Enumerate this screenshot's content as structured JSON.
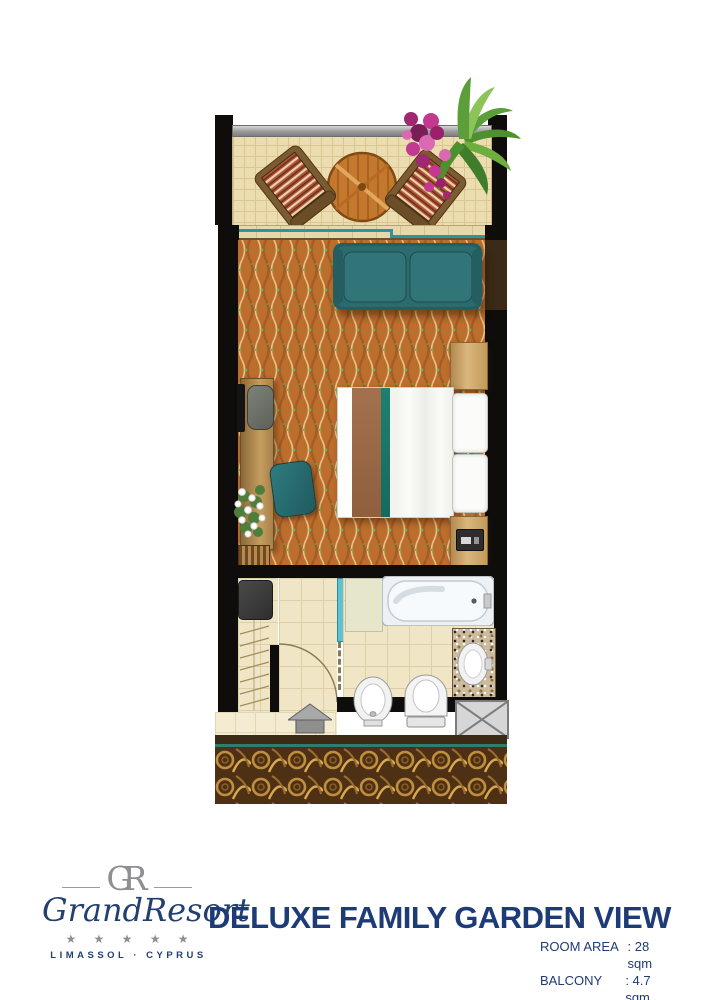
{
  "branding": {
    "monogram": "GR",
    "name": "GrandResort",
    "stars": "★ ★ ★ ★ ★",
    "location": "LIMASSOL · CYPRUS"
  },
  "room": {
    "title": "DELUXE FAMILY GARDEN VIEW",
    "specs": [
      {
        "label": "ROOM AREA",
        "value": ": 28 sqm"
      },
      {
        "label": "BALCONY",
        "value": ": 4.7 sqm"
      }
    ]
  },
  "colors": {
    "brand_navy": "#1d3b76",
    "logo_gray": "#8f8f91",
    "carpet_orange": "#bc6e2d",
    "accent_teal": "#2b6b6e",
    "corridor_brown": "#4e3015"
  }
}
